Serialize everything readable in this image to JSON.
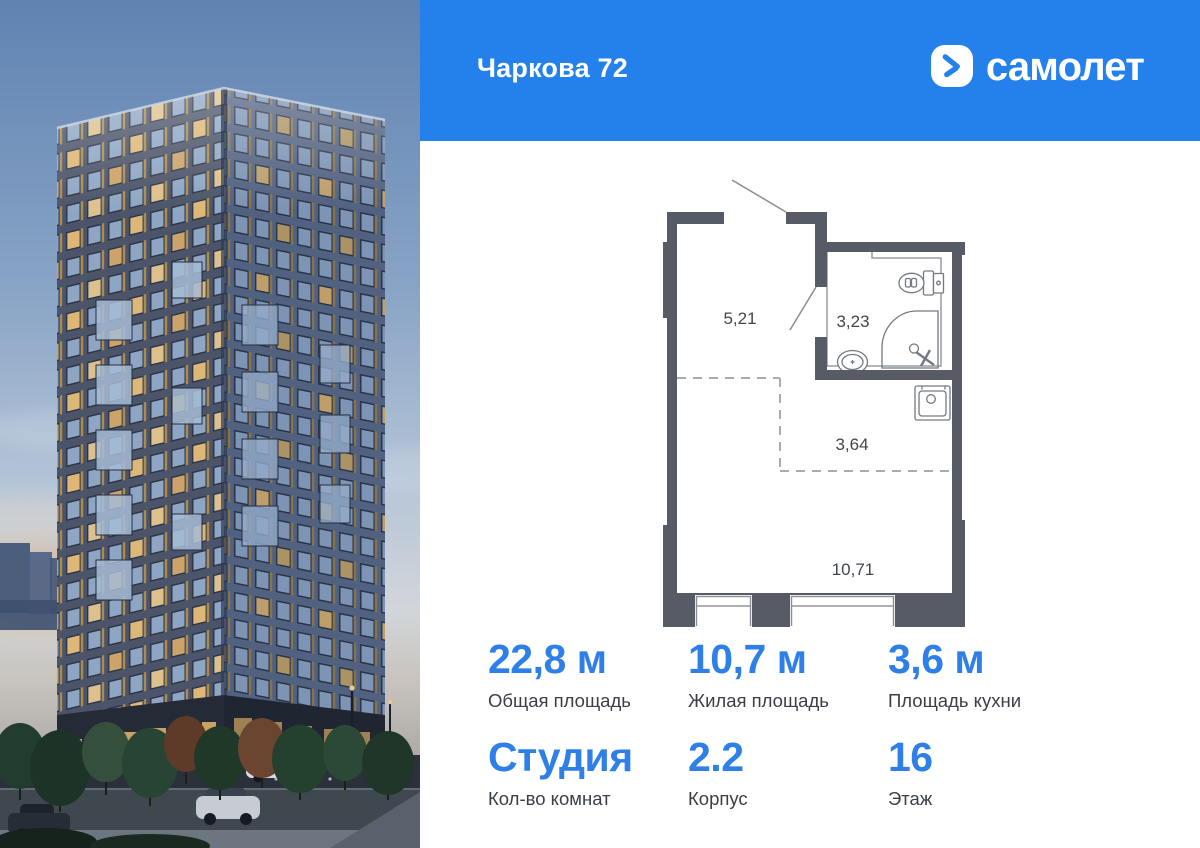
{
  "header": {
    "title": "Чаркова 72",
    "brand": "самолет",
    "colors": {
      "background": "#2481EC",
      "text": "#FFFFFF"
    }
  },
  "floor_plan": {
    "wall_color": "#565B66",
    "line_color": "#858A94",
    "rooms": [
      {
        "id": "hallway",
        "area": "5,21"
      },
      {
        "id": "bathroom",
        "area": "3,23"
      },
      {
        "id": "kitchen-zone",
        "area": "3,64"
      },
      {
        "id": "living-room",
        "area": "10,71"
      }
    ],
    "fixtures": [
      "toilet",
      "shower",
      "washbasin",
      "kitchen-sink"
    ],
    "doors": [
      "entrance-door",
      "bathroom-door"
    ]
  },
  "stats": {
    "accent_color": "#2E80E8",
    "label_color": "#3A3F47",
    "items": [
      {
        "value": "22,8 м",
        "label": "Общая площадь"
      },
      {
        "value": "10,7 м",
        "label": "Жилая площадь"
      },
      {
        "value": "3,6 м",
        "label": "Площадь кухни"
      },
      {
        "value": "Студия",
        "label": "Кол-во комнат"
      },
      {
        "value": "2.2",
        "label": "Корпус"
      },
      {
        "value": "16",
        "label": "Этаж"
      }
    ]
  }
}
